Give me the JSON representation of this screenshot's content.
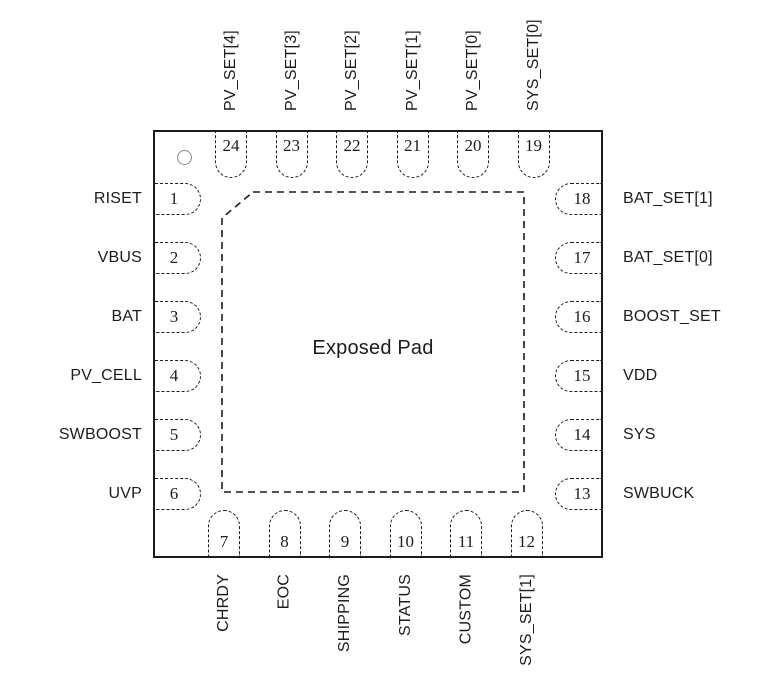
{
  "center": {
    "label": "Exposed Pad"
  },
  "pins": {
    "top": [
      {
        "num": "24",
        "label": "PV_SET[4]"
      },
      {
        "num": "23",
        "label": "PV_SET[3]"
      },
      {
        "num": "22",
        "label": "PV_SET[2]"
      },
      {
        "num": "21",
        "label": "PV_SET[1]"
      },
      {
        "num": "20",
        "label": "PV_SET[0]"
      },
      {
        "num": "19",
        "label": "SYS_SET[0]"
      }
    ],
    "left": [
      {
        "num": "1",
        "label": "RISET"
      },
      {
        "num": "2",
        "label": "VBUS"
      },
      {
        "num": "3",
        "label": "BAT"
      },
      {
        "num": "4",
        "label": "PV_CELL"
      },
      {
        "num": "5",
        "label": "SWBOOST"
      },
      {
        "num": "6",
        "label": "UVP"
      }
    ],
    "right": [
      {
        "num": "18",
        "label": "BAT_SET[1]"
      },
      {
        "num": "17",
        "label": "BAT_SET[0]"
      },
      {
        "num": "16",
        "label": "BOOST_SET"
      },
      {
        "num": "15",
        "label": "VDD"
      },
      {
        "num": "14",
        "label": "SYS"
      },
      {
        "num": "13",
        "label": "SWBUCK"
      }
    ],
    "bottom": [
      {
        "num": "7",
        "label": "CHRDY"
      },
      {
        "num": "8",
        "label": "EOC"
      },
      {
        "num": "9",
        "label": "SHIPPING"
      },
      {
        "num": "10",
        "label": "STATUS"
      },
      {
        "num": "11",
        "label": "CUSTOM"
      },
      {
        "num": "12",
        "label": "SYS_SET[1]"
      }
    ]
  },
  "colors": {
    "line": "#1c1c1c",
    "pin1_indicator": "#8a8a8a",
    "background": "#ffffff"
  }
}
